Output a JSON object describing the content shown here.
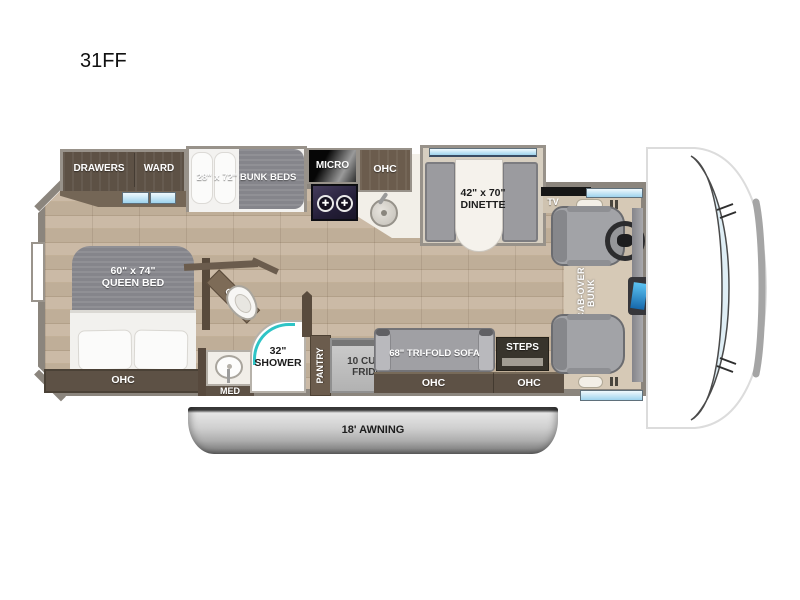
{
  "title": "31FF",
  "plan": {
    "bedroom": {
      "drawers": "DRAWERS",
      "ward": "WARD",
      "bunk_beds": "28\" x 72\" BUNK BEDS",
      "queen_bed_line1": "60\" x 74\"",
      "queen_bed_line2": "QUEEN BED",
      "ohc_bed": "OHC",
      "ohc_toilet": "OHC"
    },
    "bath": {
      "med": "MED",
      "shower_line1": "32\"",
      "shower_line2": "SHOWER"
    },
    "kitchen": {
      "micro": "MICRO",
      "ohc": "OHC",
      "pantry": "PANTRY",
      "fridge_line1": "10 CU. FT.",
      "fridge_line2": "FRIDGE"
    },
    "living": {
      "dinette_line1": "42\" x 70\"",
      "dinette_line2": "DINETTE",
      "tv": "TV",
      "sofa": "68\" TRI-FOLD SOFA",
      "ohc_sofa": "OHC",
      "steps": "STEPS",
      "ohc_entry": "OHC"
    },
    "cab": {
      "bunk_line1": "CAB-OVER",
      "bunk_line2": "BUNK"
    },
    "exterior": {
      "awning": "18' AWNING"
    }
  },
  "colors": {
    "wall_gray": "#8B857D",
    "cabinet_dark": "#5D5145",
    "cabinet_mid": "#6B5C4D",
    "floor_tan": "#C2B098",
    "mattress_gray": "#85858B",
    "window_blue": "#9ED3ED",
    "shower_teal": "#2EC4C6",
    "seat_gray": "#A0A0A4",
    "awning_gray": "#ADADAD"
  }
}
